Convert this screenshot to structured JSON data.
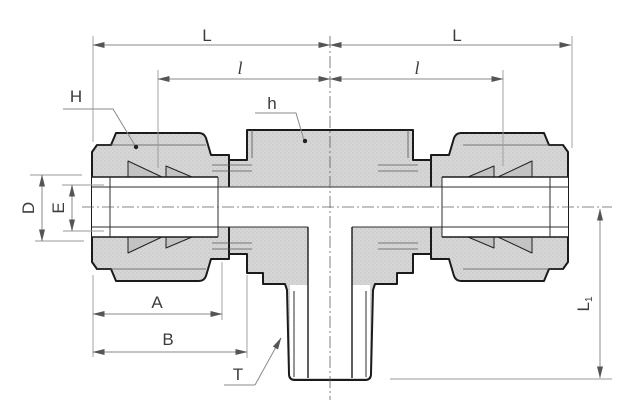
{
  "drawing": {
    "labels": {
      "L_left": "L",
      "L_right": "L",
      "l_left": "l",
      "l_right": "l",
      "H": "H",
      "h": "h",
      "D": "D",
      "E": "E",
      "A": "A",
      "B": "B",
      "T": "T",
      "L1_main": "L",
      "L1_sub": "1"
    },
    "colors": {
      "background": "#ffffff",
      "metal_fill": "#d6d6d6",
      "metal_texture_dot": "#bcbcbc",
      "ferrule_fill": "#c3c3c3",
      "outline": "#1b1b1b",
      "internal_line": "#2e2e2e",
      "dimension_line": "#8a8a8a",
      "centerline": "#606060",
      "label_text": "#3c3c3c"
    }
  }
}
